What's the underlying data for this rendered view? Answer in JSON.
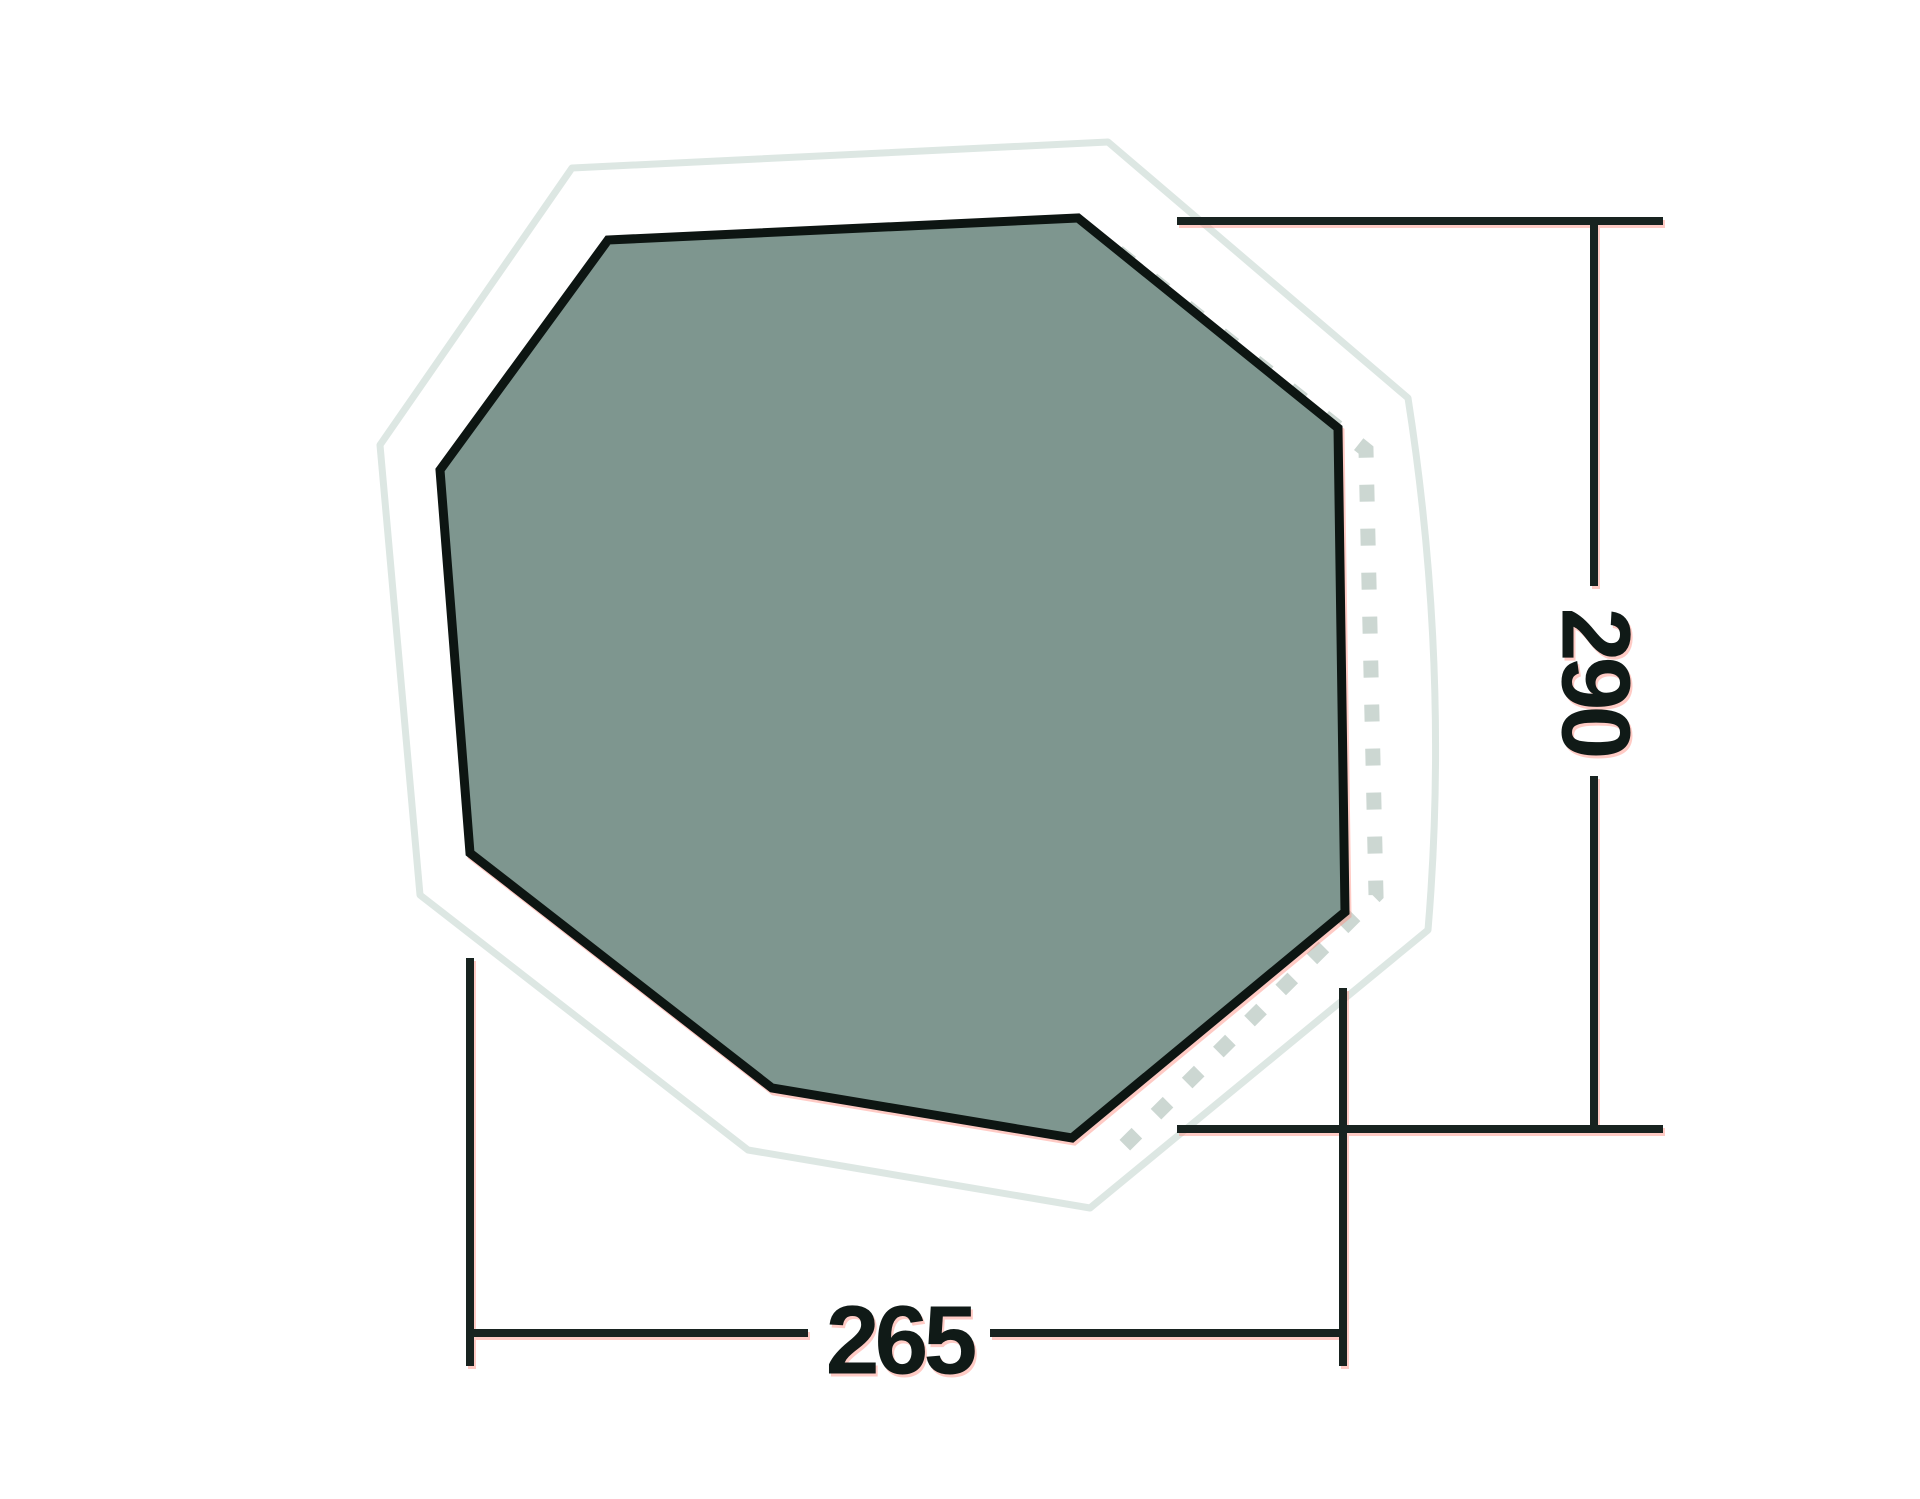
{
  "diagram": {
    "kind": "tent-footprint-top-view",
    "height_label": "290",
    "width_label": "265",
    "colors": {
      "footprint_fill": "#7e968f",
      "footprint_border": "#0d1512",
      "outer_outline": "#dde7e3",
      "dashed_seam": "#ccd7d2",
      "dimension_line": "#182320",
      "label_text": "#101a17",
      "compression_fringe": "#ff8c7e",
      "background": "#ffffff"
    },
    "inner_polygon_points": "608,240 1078,218 1338,428 1345,912 1072,1138 772,1088 470,853 440,470",
    "outer_outline_path": "M 572,168 L 1108,142 L 1408,398 Q 1450,668 1428,930 L 1090,1208 L 748,1150 L 420,895 L 380,445 Z",
    "dashed_seam_path": "M 1118,252 L 1366,450 L 1376,895 L 1112,1158"
  }
}
